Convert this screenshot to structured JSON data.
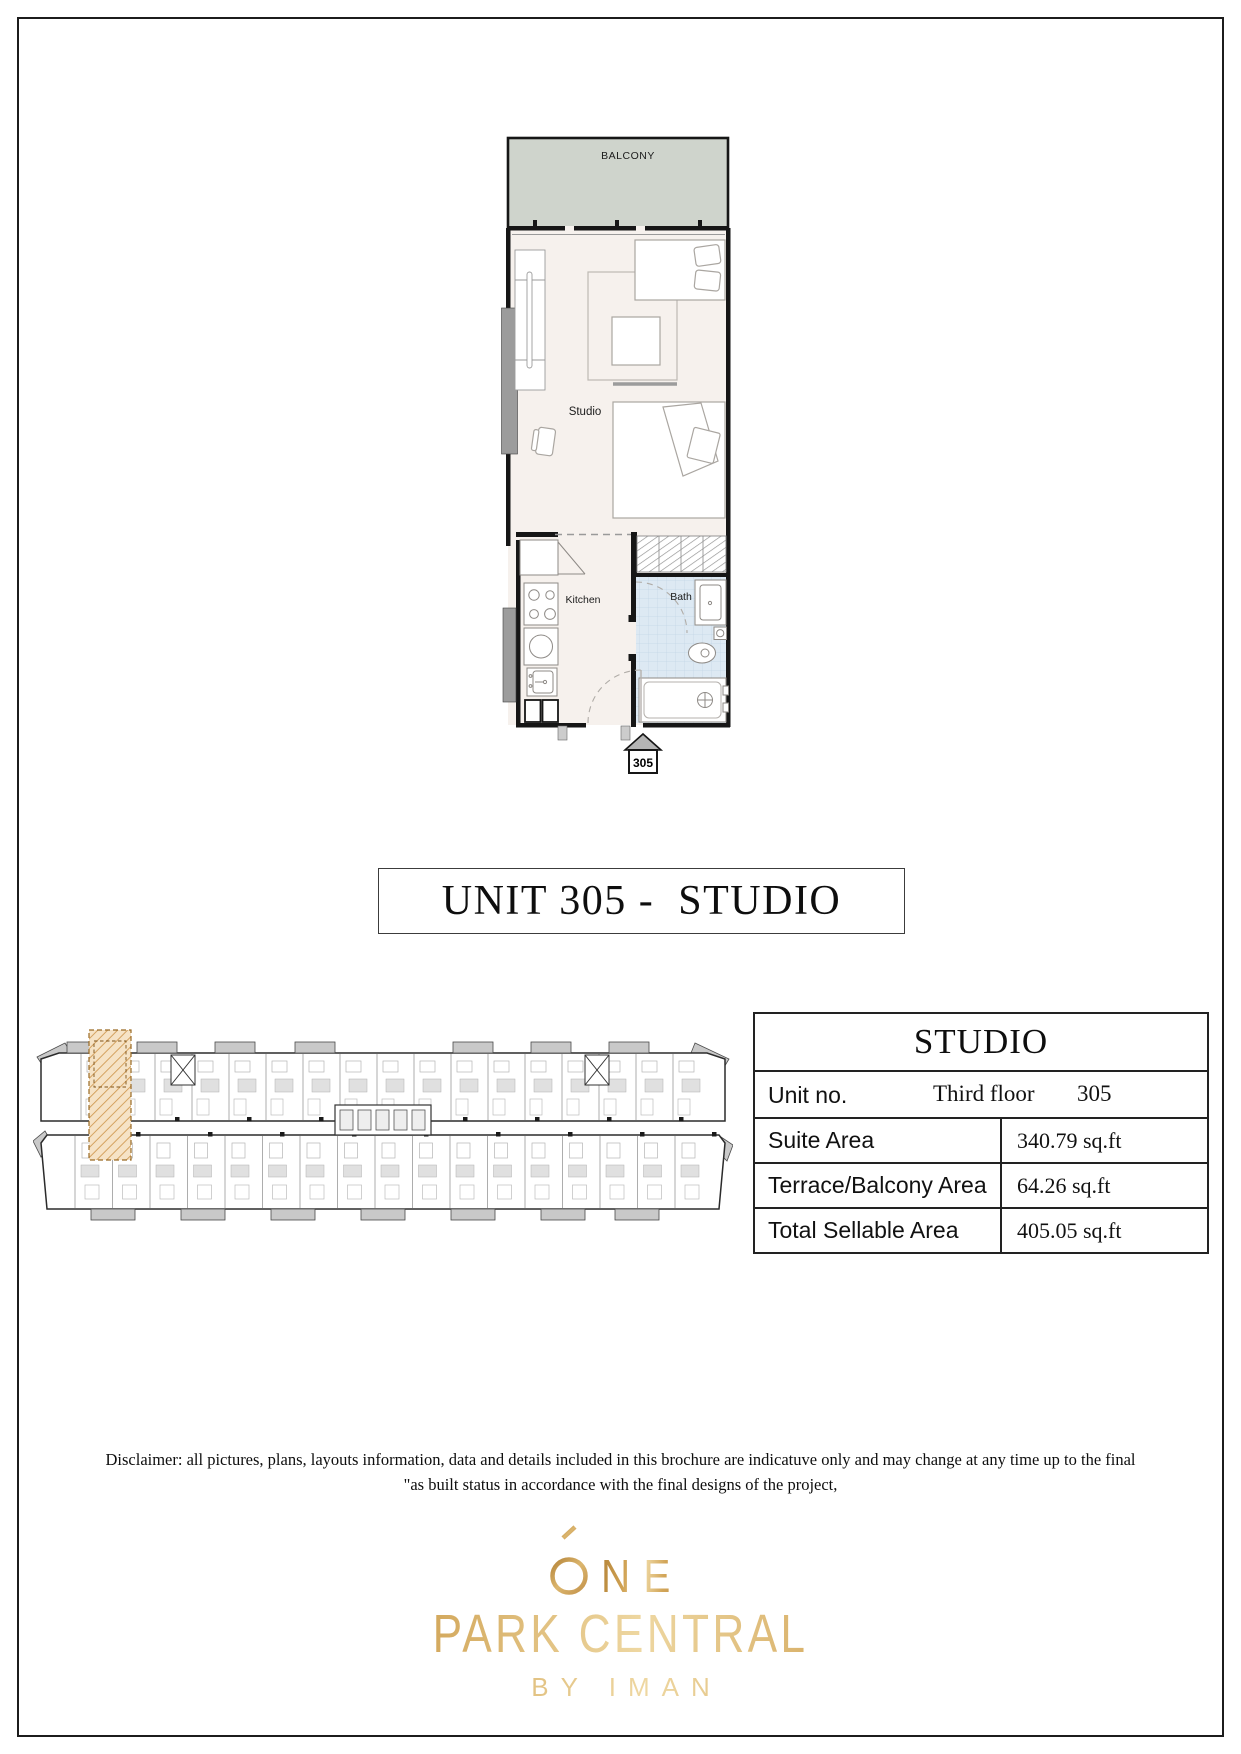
{
  "unit_plan": {
    "balcony_label": "BALCONY",
    "studio_label": "Studio",
    "kitchen_label": "Kitchen",
    "bath_label": "Bath",
    "entry_marker": "305"
  },
  "title_box": {
    "label": "UNIT 305 -  STUDIO"
  },
  "info_table": {
    "header": "STUDIO",
    "unit_row": {
      "label": "Unit no.",
      "floor": "Third floor",
      "number": "305"
    },
    "rows": [
      {
        "label": "Suite Area",
        "value": "340.79 sq.ft"
      },
      {
        "label": "Terrace/Balcony Area",
        "value": "64.26 sq.ft"
      },
      {
        "label": "Total Sellable Area",
        "value": "405.05 sq.ft"
      }
    ]
  },
  "disclaimer": {
    "line1": "Disclaimer: all pictures, plans, layouts information, data and details included in this brochure are indicatuve only and may change at any time up to the final",
    "line2": "\"as built status in accordance with the final designs of the project,"
  },
  "logo": {
    "name_line": "ONE",
    "name_line_rest": "NE",
    "line2": "PARK CENTRAL",
    "line3": "BY IMAN"
  },
  "colors": {
    "gold_accent": "#cfa152",
    "balcony_fill": "#cfd4cc",
    "bath_tile": "#dde9f3",
    "interior_fill": "#f6f1ed",
    "highlight_unit": "#f0dcbb",
    "wall": "#161616"
  }
}
